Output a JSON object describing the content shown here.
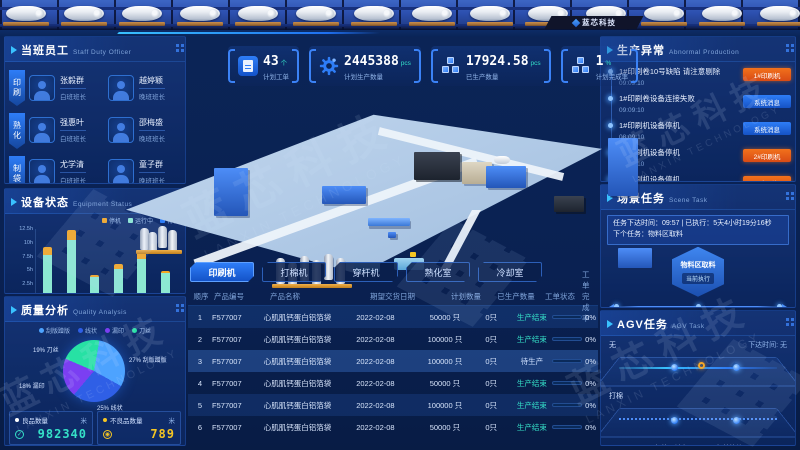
{
  "header": {
    "logo_text": "蓝芯科技"
  },
  "watermark": {
    "cn": "蓝芯科技",
    "en": "LANXIN TECHNOLOGY"
  },
  "staff": {
    "title": "当班员工",
    "subtitle": "Staff Duty Officer",
    "tabs": [
      "印刷",
      "熟化",
      "制袋"
    ],
    "members": [
      {
        "name": "张毅群",
        "role": "白班班长"
      },
      {
        "name": "越婷颖",
        "role": "晚班班长"
      },
      {
        "name": "强惠叶",
        "role": "白班班长"
      },
      {
        "name": "邵梅盛",
        "role": "晚班班长"
      },
      {
        "name": "尤学清",
        "role": "白班班长"
      },
      {
        "name": "童子群",
        "role": "晚班班长"
      }
    ]
  },
  "equipment": {
    "title": "设备状态",
    "subtitle": "Equipment Status",
    "chart": {
      "type": "bar",
      "stacked": true,
      "categories": [
        "印刷",
        "复合",
        "熟化",
        "冷却",
        "打棉",
        "穿杆"
      ],
      "series": [
        {
          "name": "待机",
          "color": "#2e7df7",
          "values": [
            0.8,
            0.8,
            0.8,
            0.8,
            0.8,
            0.8
          ]
        },
        {
          "name": "运行中",
          "color": "#8ce8d2",
          "values": [
            6.9,
            9.5,
            3.0,
            4.4,
            6.2,
            3.6
          ]
        },
        {
          "name": "停机",
          "color": "#f5a623",
          "values": [
            1.5,
            1.9,
            0.4,
            0.8,
            1.3,
            0.5
          ]
        }
      ],
      "yticks": [
        "0h",
        "2.5h",
        "5h",
        "7.5h",
        "10h",
        "12.5h"
      ],
      "ymax": 12.5,
      "ylabel": "",
      "legend_position": "top-right"
    }
  },
  "quality": {
    "title": "质量分析",
    "subtitle": "Quality Analysis",
    "chart": {
      "type": "pie",
      "slices": [
        {
          "name": "刮版蹭版",
          "pct": 27,
          "color": "#4da3ff"
        },
        {
          "name": "线状",
          "pct": 25,
          "color": "#2f5fe6"
        },
        {
          "name": "漏印",
          "pct": 18,
          "color": "#7b3ff2"
        },
        {
          "name": "刀丝",
          "pct": 19,
          "color": "#27e1a4"
        }
      ]
    },
    "stats": [
      {
        "label": "良品数量",
        "unit": "米",
        "value": "982340",
        "color": "#35e0c8",
        "dot": "#ffffff",
        "ring": "#35e0c8",
        "mark": "✓"
      },
      {
        "label": "不良品数量",
        "unit": "米",
        "value": "789",
        "color": "#f5c623",
        "dot": "#f5c623",
        "ring": "#f5c623",
        "mark": "◉"
      },
      {
        "label": "良品率",
        "unit": "",
        "value": "98%",
        "color": "#e8f0ff",
        "dot": "#4da3ff",
        "ring": "#4da3ff",
        "mark": "✓"
      }
    ]
  },
  "kpis": [
    {
      "icon": "clipboard",
      "value": "43",
      "unit": "个",
      "label": "计划工单"
    },
    {
      "icon": "gear",
      "value": "2445388",
      "unit": "pcs",
      "label": "计划生产数量"
    },
    {
      "icon": "boxes",
      "value": "17924.58",
      "unit": "pcs",
      "label": "已生产数量"
    },
    {
      "icon": "boxes",
      "value": "1",
      "unit": "%",
      "label": "计划完成率"
    }
  ],
  "machine_tabs": [
    {
      "label": "印刷机",
      "active": true
    },
    {
      "label": "打棉机",
      "active": false
    },
    {
      "label": "穿杆机",
      "active": false
    },
    {
      "label": "熟化室",
      "active": false
    },
    {
      "label": "冷却室",
      "active": false
    }
  ],
  "orders": {
    "headers": [
      "顺序",
      "产品编号",
      "产品名称",
      "期望交货日期",
      "计划数量",
      "已生产数量",
      "工单状态",
      "工单完成率"
    ],
    "rows": [
      {
        "seq": "1",
        "code": "F577007",
        "name": "心肌肌钙蛋白铝箔袋",
        "date": "2022-02-08",
        "plan": "50000 只",
        "produced": "0只",
        "status": "生产结束",
        "pct": "0%"
      },
      {
        "seq": "2",
        "code": "F577007",
        "name": "心肌肌钙蛋白铝箔袋",
        "date": "2022-02-08",
        "plan": "100000 只",
        "produced": "0只",
        "status": "生产结束",
        "pct": "0%"
      },
      {
        "seq": "3",
        "code": "F577007",
        "name": "心肌肌钙蛋白铝箔袋",
        "date": "2022-02-08",
        "plan": "100000 只",
        "produced": "0只",
        "status": "待生产",
        "pct": "0%"
      },
      {
        "seq": "4",
        "code": "F577007",
        "name": "心肌肌钙蛋白铝箔袋",
        "date": "2022-02-08",
        "plan": "50000 只",
        "produced": "0只",
        "status": "生产结束",
        "pct": "0%"
      },
      {
        "seq": "5",
        "code": "F577007",
        "name": "心肌肌钙蛋白铝箔袋",
        "date": "2022-02-08",
        "plan": "100000 只",
        "produced": "0只",
        "status": "生产结束",
        "pct": "0%"
      },
      {
        "seq": "6",
        "code": "F577007",
        "name": "心肌肌钙蛋白铝箔袋",
        "date": "2022-02-08",
        "plan": "50000 只",
        "produced": "0只",
        "status": "生产结束",
        "pct": "0%"
      }
    ]
  },
  "abnormal": {
    "title": "生产异常",
    "subtitle": "Abnormal Production",
    "items": [
      {
        "msg": "1#印刷卷10号缺陷 请注意剔除",
        "time": "09:09:10",
        "badge": "1#印刷机",
        "kind": "machine"
      },
      {
        "msg": "1#印刷卷设备连接失败",
        "time": "09:09:10",
        "badge": "系统消息",
        "kind": "system"
      },
      {
        "msg": "1#印刷机设备停机",
        "time": "08:09:10",
        "badge": "系统消息",
        "kind": "system"
      },
      {
        "msg": "2#印刷机设备停机",
        "time": "08:09:10",
        "badge": "2#印刷机",
        "kind": "machine"
      },
      {
        "msg": "4#印刷机设备停机",
        "time": "08:09:10",
        "badge": "4#印刷机",
        "kind": "machine"
      }
    ]
  },
  "scene_task": {
    "title": "场景任务",
    "subtitle": "Scene Task",
    "info": "任务下达时间：09:57 | 已执行：5天4小时19分16秒　下个任务：物料区取料",
    "hex_main": "物料区取料",
    "hex_sub": "当前执行",
    "timeline": [
      "暂无",
      "暂无",
      "暂无"
    ]
  },
  "agv": {
    "title": "AGV任务",
    "subtitle": "AGV Task",
    "routes": [
      {
        "name": "无",
        "meta": "下达时间: 无",
        "points": [],
        "style": "solid"
      },
      {
        "name": "打棉",
        "meta": "",
        "points": [
          "打棉下料点",
          "打棉等待区"
        ],
        "style": "dotted"
      }
    ]
  }
}
